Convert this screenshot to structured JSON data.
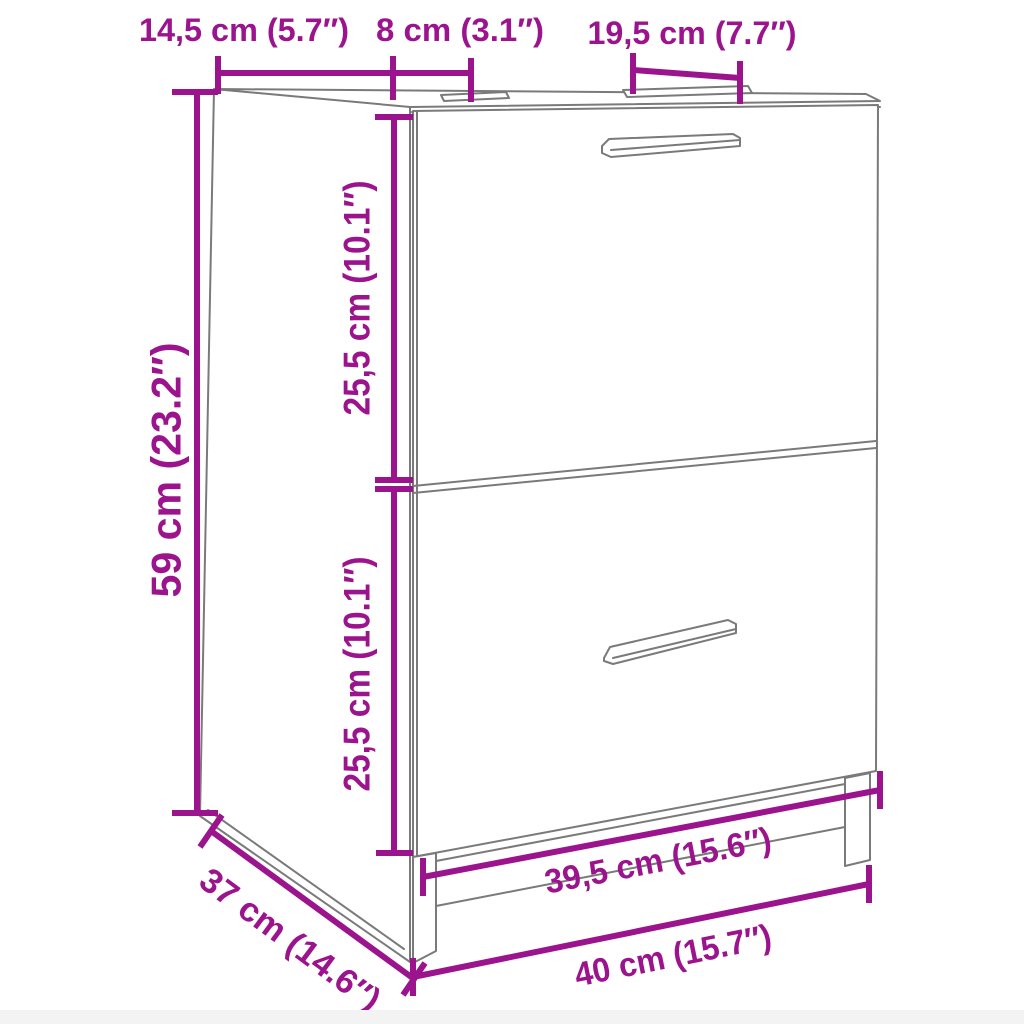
{
  "image": {
    "description": "Technical dimension drawing of a two-drawer sink cabinet",
    "background": "#ffffff",
    "accent_color": "#9b148d",
    "outline_color": "#7a7a7a"
  },
  "labels": {
    "top_depth": "14,5 cm (5.7″)",
    "top_gap": "8 cm (3.1″)",
    "top_opening": "19,5 cm (7.7″)",
    "height": "59 cm (23.2″)",
    "upper_front": "25,5 cm (10.1″)",
    "lower_front": "25,5 cm (10.1″)",
    "depth": "37 cm (14.6″)",
    "inner_width": "39,5 cm (15.6″)",
    "width": "40 cm (15.7″)"
  }
}
